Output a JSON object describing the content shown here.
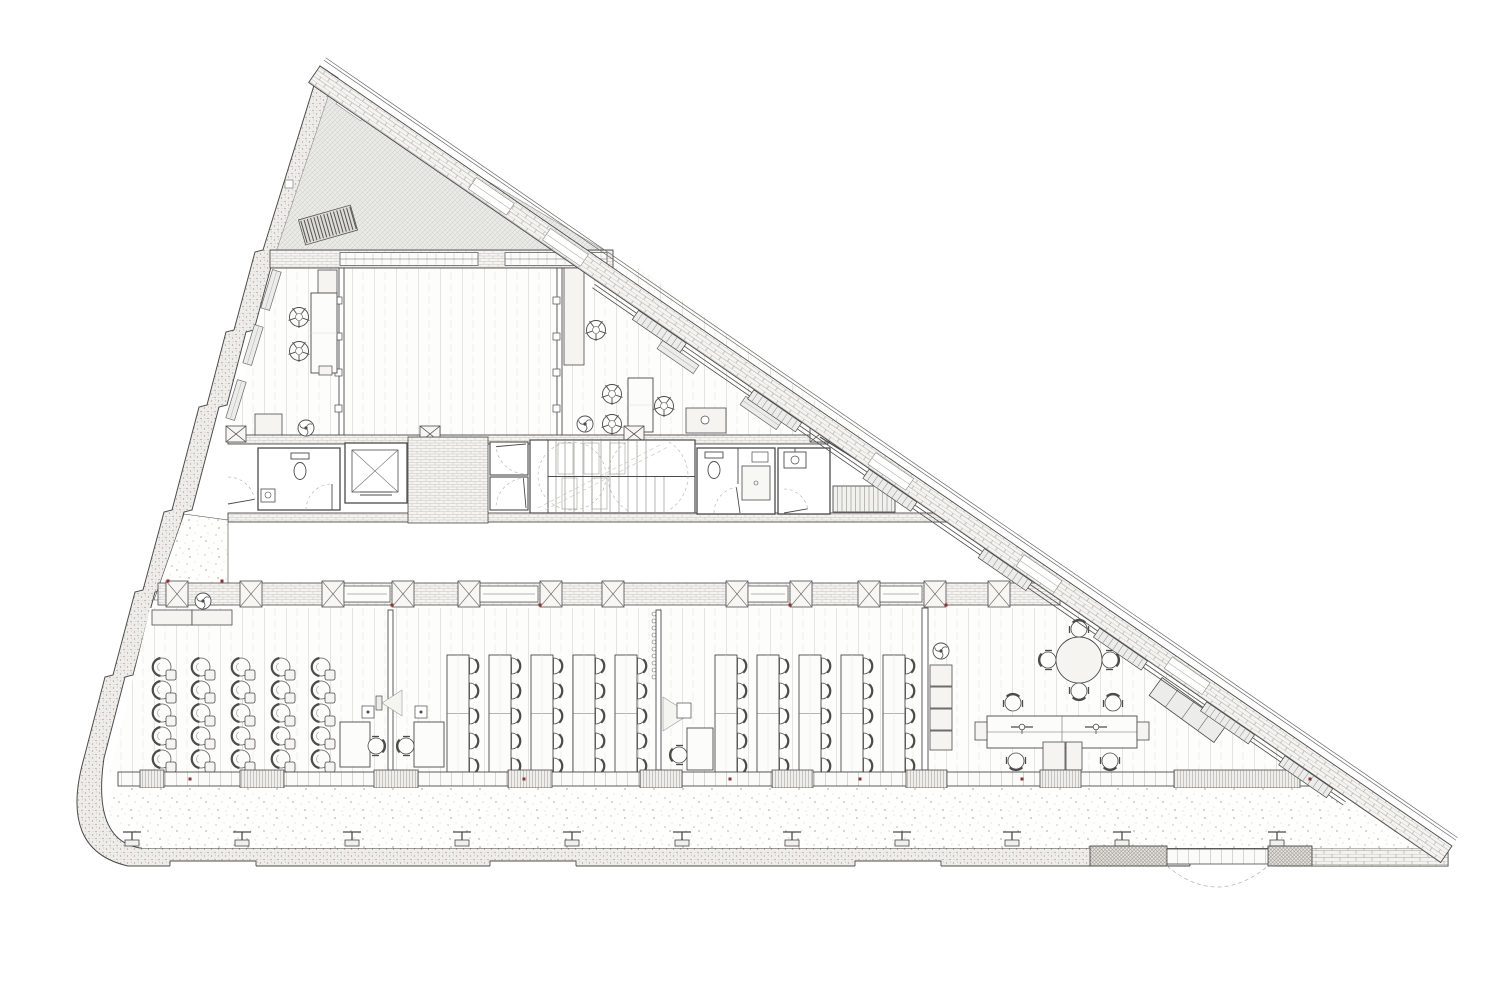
{
  "palette": {
    "ink": "#4b4b4b",
    "ink2": "#6b6b68",
    "light": "#9a9a96",
    "faint": "#c2c1bc",
    "fillA": "#fcfcfb",
    "fillB": "#f5f4f1",
    "fillC": "#ececea",
    "dense_line": "#93908a",
    "red": "#8a3433",
    "dash": "#b0afaa"
  },
  "plan": {
    "envelope": {
      "west_outer": [
        [
          320,
          66
        ],
        [
          263,
          250
        ],
        [
          255,
          252
        ],
        [
          234,
          330
        ],
        [
          226,
          332
        ],
        [
          207,
          405
        ],
        [
          199,
          407
        ],
        [
          172,
          510
        ],
        [
          164,
          512
        ],
        [
          143,
          590
        ],
        [
          135,
          592
        ],
        [
          113,
          675
        ],
        [
          105,
          677
        ],
        [
          84,
          758
        ]
      ],
      "west_inner": [
        [
          104,
          758
        ],
        [
          125,
          677
        ],
        [
          133,
          675
        ],
        [
          155,
          592
        ],
        [
          163,
          590
        ],
        [
          184,
          512
        ],
        [
          192,
          510
        ],
        [
          219,
          407
        ],
        [
          227,
          405
        ],
        [
          246,
          332
        ],
        [
          254,
          330
        ],
        [
          275,
          252
        ],
        [
          283,
          250
        ],
        [
          338,
          78
        ]
      ],
      "corner_out": [
        58,
        850,
        128,
        866
      ],
      "corner_in": [
        92,
        840
      ],
      "bottom": {
        "x_right": 1448,
        "y_top": 848,
        "y_bot": 866,
        "x_left_top": 140
      },
      "brick_right": [
        1310,
        848,
        138,
        18
      ],
      "notches_x": [
        170,
        490,
        855,
        1190
      ],
      "notch_w": 86,
      "hyp": {
        "A": [
          320,
          66
        ],
        "B": [
          1452,
          846
        ],
        "band_w": 20,
        "angle": 34.6,
        "parapet_off": [
          7,
          10
        ],
        "gaps_t": [
          215,
          305,
          700,
          880,
          1060
        ],
        "glazing": {
          "t0": 350,
          "t1": 1262,
          "off": [
            24,
            28
          ]
        },
        "mullions_t": [
          430,
          570,
          710,
          850,
          990,
          1120,
          1215
        ]
      }
    },
    "roof": {
      "poly": [
        [
          331,
          88
        ],
        [
          607,
          252
        ],
        [
          276,
          252
        ]
      ],
      "louver": [
        328,
        225,
        54,
        26,
        -16
      ],
      "notch": [
        352,
        107,
        30,
        13,
        34.6
      ],
      "small_sq": [
        285,
        180,
        8,
        8
      ]
    },
    "north_wall": {
      "base": [
        270,
        250,
        343,
        18
      ],
      "panels": [
        [
          340,
          252.5,
          138,
          13
        ],
        [
          505,
          252.5,
          102,
          13
        ]
      ]
    },
    "upper": {
      "poly": [
        [
          273,
          268
        ],
        [
          640,
          268
        ],
        [
          862,
          437
        ],
        [
          228,
          437
        ]
      ],
      "partitions": [
        [
          339,
          268,
          5,
          169
        ],
        [
          557,
          268,
          5,
          169
        ]
      ],
      "posts": [
        [
          338,
          300
        ],
        [
          338,
          336
        ],
        [
          338,
          372
        ],
        [
          338,
          408
        ],
        [
          556,
          300
        ],
        [
          556,
          336
        ],
        [
          556,
          372
        ],
        [
          556,
          408
        ]
      ],
      "shelf": [
        318,
        270,
        19,
        24
      ],
      "tables": [
        [
          311,
          293,
          26,
          80
        ],
        [
          628,
          378,
          25,
          54
        ]
      ],
      "cabinets": [
        [
          255,
          414,
          27,
          22
        ],
        [
          564,
          268,
          20,
          97
        ],
        [
          686,
          408,
          40,
          25
        ]
      ],
      "small_box": [
        319,
        366,
        13,
        9
      ],
      "stools": [
        [
          299,
          317
        ],
        [
          299,
          351
        ],
        [
          596,
          330
        ],
        [
          612,
          394
        ],
        [
          612,
          424
        ],
        [
          664,
          406
        ]
      ],
      "sink_circle": [
        705,
        420,
        4
      ],
      "radiators_west": [
        [
          271,
          290
        ],
        [
          253,
          345
        ],
        [
          236,
          400
        ]
      ],
      "radiators_hyp": [
        [
          678,
          357
        ],
        [
          761,
          413
        ]
      ]
    },
    "core": {
      "top_wall": [
        228,
        435,
        600,
        9
      ],
      "bottom_wall": [
        228,
        513,
        736,
        9
      ],
      "xboxes": [
        [
          236,
          433
        ],
        [
          430,
          433
        ],
        [
          634,
          433
        ],
        [
          820,
          433
        ]
      ],
      "right_wall": [
        [
          820,
          437
        ],
        [
          958,
          523
        ],
        [
          826,
          434
        ],
        [
          964,
          520
        ]
      ],
      "wc_a": {
        "room": [
          258,
          448,
          82,
          62
        ],
        "tank": [
          291,
          453,
          18,
          6
        ],
        "bowl": [
          300,
          471,
          6,
          8.5
        ],
        "sink": [
          261,
          489,
          14,
          13
        ],
        "sink_c": [
          268,
          495,
          3
        ]
      },
      "elev1": {
        "shaft": [
          345,
          443,
          62,
          60
        ],
        "car": [
          352,
          450,
          46,
          42
        ],
        "door_y": [
          492,
          495
        ],
        "door_x": [
          360,
          392
        ]
      },
      "lobby": [
        408,
        437,
        80,
        86
      ],
      "shaft2": {
        "cells": [
          [
            490,
            442,
            38,
            33
          ],
          [
            490,
            477,
            38,
            33
          ]
        ]
      },
      "stair": {
        "box": [
          530,
          440,
          165,
          73
        ],
        "mid_y": 476.5,
        "mid_x0": 548,
        "treads_top": {
          "x0": 556,
          "x1": 646,
          "dx": 9,
          "y0": 441,
          "y1": 476
        },
        "treads_bot": {
          "x0": 556,
          "x1": 664,
          "dx": 9,
          "y0": 477,
          "y1": 512
        },
        "frames": [
          [
            558,
            443,
            15,
            31
          ],
          [
            584,
            443,
            15,
            31
          ],
          [
            610,
            443,
            15,
            31
          ],
          [
            562,
            478,
            15,
            31
          ],
          [
            592,
            478,
            15,
            31
          ]
        ],
        "circles": [
          [
            572,
            476,
            34
          ],
          [
            648,
            476,
            40
          ]
        ],
        "diags": [
          [
            538,
            508,
            660,
            445
          ],
          [
            545,
            510,
            668,
            447
          ]
        ]
      },
      "wc_b": {
        "room": [
          697,
          448,
          78,
          66
        ],
        "tank": [
          705,
          452,
          18,
          6
        ],
        "bowl": [
          714,
          470,
          6,
          8.5
        ],
        "divider": [
          738,
          448,
          738,
          484
        ],
        "shower": [
          742,
          466,
          28,
          34
        ],
        "drain": [
          756,
          483,
          2
        ],
        "shelfs": [
          752,
          452,
          16,
          10
        ]
      },
      "util": {
        "room": [
          778,
          448,
          52,
          66
        ],
        "sink": [
          784,
          452,
          22,
          16
        ],
        "sink_c": [
          795,
          460,
          4
        ]
      },
      "small_stair": {
        "box": [
          833,
          486,
          62,
          26
        ],
        "dx": 4.5
      },
      "doors": [
        {
          "h": [
            332,
            510
          ],
          "r": 26,
          "a0": 180,
          "a1": 270
        },
        {
          "h": [
            228,
            504
          ],
          "r": 27,
          "a0": 270,
          "a1": 350
        },
        {
          "h": [
            526,
            444
          ],
          "r": 30,
          "a0": 95,
          "a1": 175
        },
        {
          "h": [
            526,
            508
          ],
          "r": 30,
          "a0": 185,
          "a1": 265
        },
        {
          "h": [
            740,
            513
          ],
          "r": 26,
          "a0": 180,
          "a1": 262
        },
        {
          "h": [
            784,
            513
          ],
          "r": 24,
          "a0": 270,
          "a1": 350
        }
      ]
    },
    "wedge_poly": [
      [
        184,
        514
      ],
      [
        228,
        520
      ],
      [
        228,
        600
      ],
      [
        154,
        600
      ]
    ],
    "band_e": {
      "base": [
        158,
        583,
        902,
        22
      ],
      "piers_x": [
        166,
        240,
        322,
        392,
        458,
        540,
        602,
        726,
        790,
        858,
        924,
        988
      ],
      "pier": [
        22,
        26
      ],
      "panels": [
        [
          344,
          586,
          46,
          16
        ],
        [
          480,
          586,
          58,
          16
        ],
        [
          748,
          586,
          40,
          16
        ],
        [
          880,
          586,
          42,
          16
        ]
      ],
      "radiators": [
        {
          "y": 613,
          "x0": 350,
          "x1": 392,
          "dx": 7
        },
        {
          "y": 613,
          "x0": 598,
          "x1": 662,
          "dx": 8
        }
      ]
    },
    "office": {
      "poly": [
        [
          150,
          608
        ],
        [
          1090,
          608
        ],
        [
          1312,
          772
        ],
        [
          110,
          772
        ]
      ],
      "cabinets_nw": [
        [
          152,
          610,
          40,
          15
        ],
        [
          192,
          610,
          40,
          15
        ]
      ],
      "lounge": {
        "cols": [
          162,
          201,
          241,
          281,
          321
        ],
        "rows": [
          667,
          690,
          713,
          736,
          759
        ]
      },
      "partition1": {
        "rect": [
          388,
          610,
          5,
          162
        ],
        "screen": [
          376,
          696,
          6,
          14
        ],
        "cone": [
          [
            382,
            703
          ],
          [
            402,
            690
          ],
          [
            402,
            716
          ]
        ],
        "boxes": [
          [
            362,
            706,
            12,
            12
          ],
          [
            415,
            706,
            12,
            12
          ]
        ],
        "desks": [
          [
            340,
            722,
            30,
            45
          ],
          [
            414,
            722,
            30,
            45
          ]
        ],
        "chairs": [
          [
            376,
            746,
            90
          ],
          [
            406,
            746,
            270
          ]
        ]
      },
      "groupA": {
        "xs": [
          447,
          489,
          531,
          573,
          615
        ],
        "y": 655,
        "w": 22,
        "h": 117,
        "chair_rows": [
          666,
          691,
          716,
          741,
          766
        ]
      },
      "partition2": {
        "rect": [
          656,
          610,
          5,
          160
        ],
        "hooks": {
          "x": 654,
          "y0": 614,
          "n": 10,
          "dy": 7
        },
        "cone": [
          [
            663,
            697
          ],
          [
            690,
            714
          ],
          [
            663,
            731
          ]
        ],
        "box": [
          677,
          703,
          14,
          15
        ],
        "desk": [
          687,
          728,
          26,
          42
        ],
        "chair": [
          679,
          755,
          270
        ]
      },
      "groupB": {
        "xs": [
          715,
          757,
          799,
          841,
          883
        ],
        "y": 655,
        "w": 22,
        "h": 117,
        "chair_rows": [
          666,
          691,
          716,
          741,
          766
        ]
      },
      "partition3": {
        "rect": [
          922,
          608,
          6,
          162
        ],
        "stack": [
          [
            930,
            665,
            22,
            21
          ],
          [
            930,
            687,
            22,
            21
          ],
          [
            930,
            709,
            22,
            21
          ],
          [
            930,
            731,
            22,
            19
          ]
        ]
      },
      "exec": {
        "table": [
          1079,
          660,
          23
        ],
        "desk": [
          987,
          716,
          150,
          32
        ],
        "monitors": [
          [
            1022,
            727
          ],
          [
            1096,
            727
          ]
        ],
        "tabs": [
          [
            975,
            722,
            12,
            18
          ],
          [
            1137,
            722,
            12,
            18
          ]
        ],
        "chairs": [
          [
            1013,
            703,
            0
          ],
          [
            1113,
            703,
            0
          ],
          [
            1016,
            761,
            180
          ],
          [
            1110,
            761,
            180
          ]
        ],
        "cabs": [
          [
            1043,
            742,
            22,
            28
          ],
          [
            1066,
            742,
            16,
            28
          ]
        ],
        "credenza": [
          1188,
          710,
          80,
          22,
          36
        ]
      }
    },
    "facade": {
      "base": [
        118,
        772,
        1226,
        14
      ],
      "piers": [
        [
          140,
          24
        ],
        [
          240,
          44
        ],
        [
          374,
          44
        ],
        [
          508,
          44
        ],
        [
          640,
          42
        ],
        [
          772,
          41
        ],
        [
          906,
          41
        ],
        [
          1040,
          41
        ],
        [
          1174,
          126
        ]
      ]
    },
    "terrace": {
      "poly": [
        [
          112,
          788
        ],
        [
          1338,
          788
        ],
        [
          1421,
          848
        ],
        [
          142,
          848
        ],
        [
          104,
          810
        ]
      ],
      "columns_x": [
        132,
        242,
        352,
        462,
        572,
        682,
        792,
        902,
        1012,
        1122,
        1277
      ],
      "col_y": 832
    },
    "gate": {
      "piers": [
        [
          1090,
          846,
          77,
          20
        ],
        [
          1268,
          846,
          44,
          20
        ]
      ],
      "strip": [
        1167,
        849,
        101,
        15
      ],
      "arc": [
        1167,
        866,
        1217,
        908,
        1268,
        866
      ]
    },
    "markers": {
      "fans": [
        [
          306,
          428
        ],
        [
          585,
          424
        ],
        [
          203,
          601
        ],
        [
          941,
          651
        ]
      ],
      "red_dots": [
        [
          168,
          581
        ],
        [
          222,
          581
        ],
        [
          392,
          605
        ],
        [
          540,
          605
        ],
        [
          790,
          605
        ],
        [
          946,
          605
        ],
        [
          190,
          779
        ],
        [
          524,
          779
        ],
        [
          730,
          779
        ],
        [
          860,
          779
        ],
        [
          1022,
          779
        ],
        [
          1310,
          779
        ]
      ]
    }
  }
}
